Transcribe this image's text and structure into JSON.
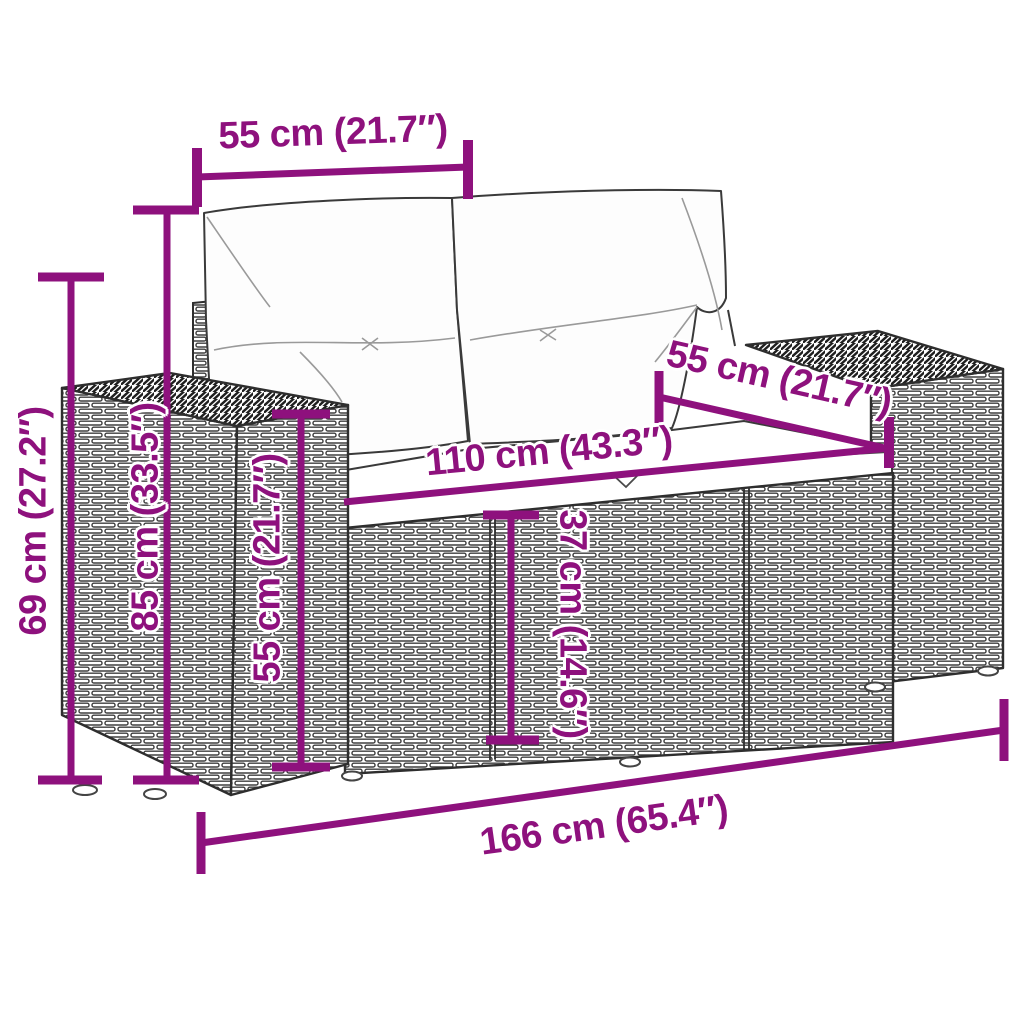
{
  "colors": {
    "dimension_accent": "#8E117D",
    "drawing_line": "#2e2e2e"
  },
  "dimensions": {
    "top_width": "55 cm (21.7″)",
    "overall_height": "69 cm (27.2″)",
    "back_height": "85 cm (33.5″)",
    "arm_height": "55 cm (21.7″)",
    "seat_width": "110 cm (43.3″)",
    "seat_depth": "55 cm (21.7″)",
    "seat_height": "37 cm (14.6″)",
    "total_width": "166 cm (65.4″)"
  }
}
